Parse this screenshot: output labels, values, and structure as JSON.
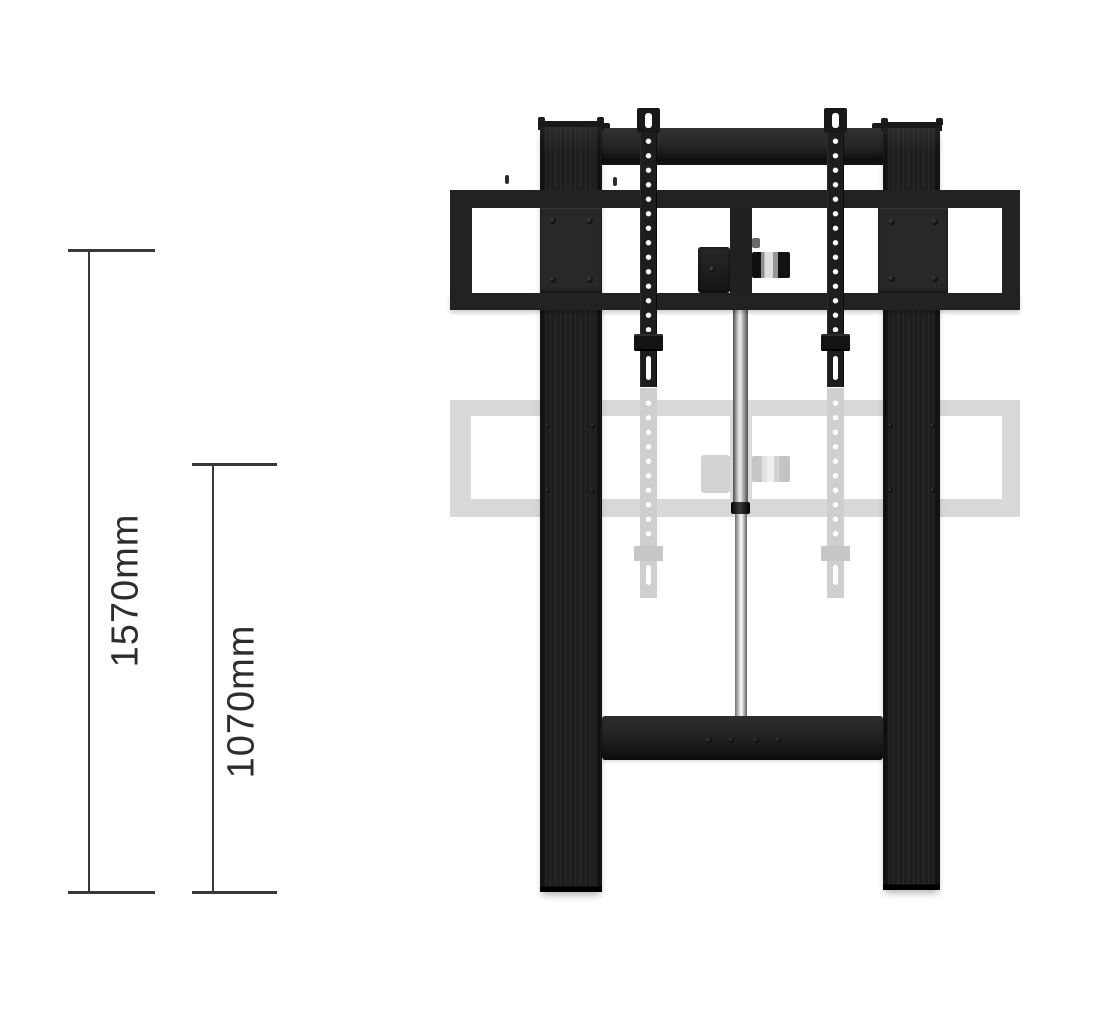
{
  "diagram": {
    "subject": "motorised height-adjustable TV floor stand shown in raised (solid) and lowered (faded) positions",
    "dimensions": [
      {
        "label": "1570mm",
        "value": 1570,
        "unit": "mm",
        "description": "height at raised position"
      },
      {
        "label": "1070mm",
        "value": 1070,
        "unit": "mm",
        "description": "height at lowered position"
      }
    ]
  },
  "colors": {
    "stand_black": "#222222",
    "ghost_gray": "#d9d9d9",
    "pole_silver": "#c0c0c0",
    "dimension_line": "#383838",
    "label_text": "#2d2d2d",
    "background": "#ffffff"
  }
}
